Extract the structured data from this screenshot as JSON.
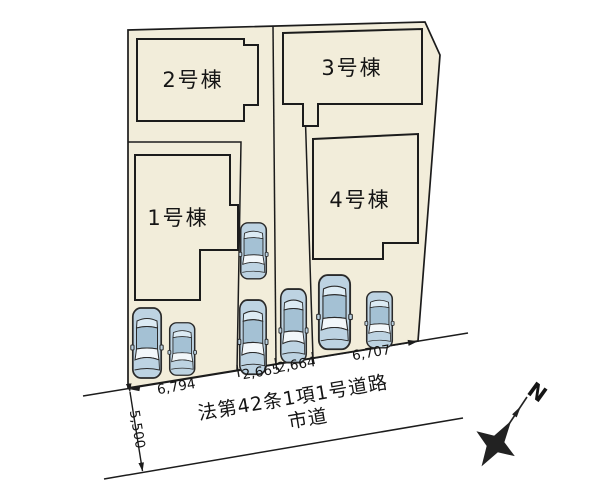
{
  "diagram": {
    "title": "分譲地 区画図",
    "buildings": [
      {
        "label": "1号棟"
      },
      {
        "label": "2号棟"
      },
      {
        "label": "3号棟"
      },
      {
        "label": "4号棟"
      }
    ],
    "dimensions": {
      "lot1_frontage": "6,794",
      "lot2_frontage": "2,665",
      "lot3_frontage": "2,664",
      "lot4_frontage": "6,707",
      "road_width": "5,500"
    },
    "road": {
      "designation": "法第42条1項1号道路",
      "type": "市道"
    },
    "compass": {
      "north": "N"
    },
    "colors": {
      "background": "#ffffff",
      "plot_fill": "#f2edda",
      "line": "#1c1c1c",
      "car_body": "#bdd3e2",
      "car_roof": "#a4c1d4",
      "car_glass": "#f2f7fa",
      "compass": "#222222"
    }
  }
}
